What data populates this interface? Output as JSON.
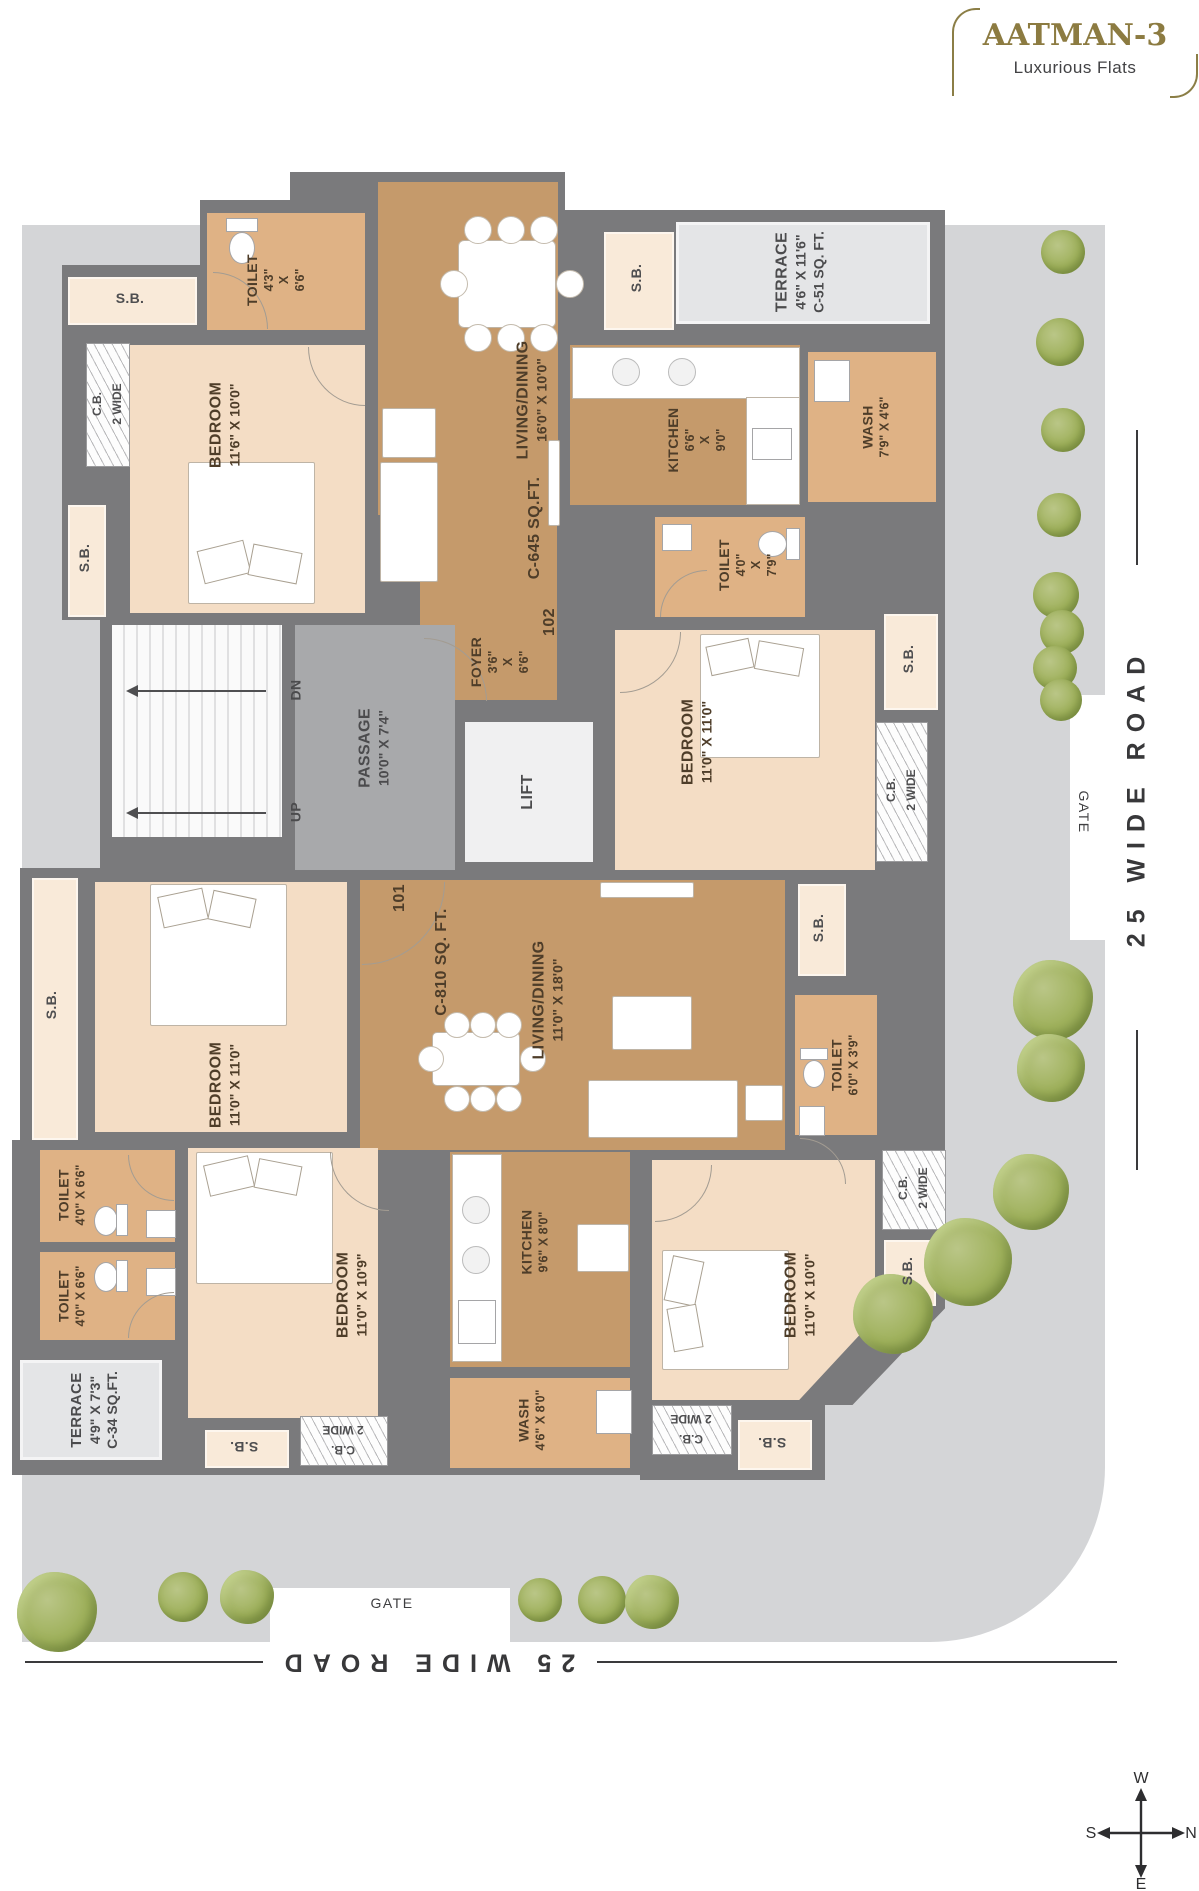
{
  "project": {
    "name": "AATMAN-3",
    "tagline": "Luxurious Flats"
  },
  "units": {
    "u102": {
      "number": "102",
      "area": "C-645 SQ.FT.",
      "toilet_a": {
        "name": "TOILET",
        "dim": "4'3\"\nX\n6'6\""
      },
      "living": {
        "name": "LIVING/DINING",
        "dim": "16'0\" X 10'0\""
      },
      "bedroom_a": {
        "name": "BEDROOM",
        "dim": "11'6\" X 10'0\""
      },
      "kitchen": {
        "name": "KITCHEN",
        "dim": "6'6\"\nX\n9'0\""
      },
      "wash": {
        "name": "WASH",
        "dim": "7'9\" X 4'6\""
      },
      "toilet_b": {
        "name": "TOILET",
        "dim": "4'0\"\nX\n7'9\""
      },
      "bedroom_b": {
        "name": "BEDROOM",
        "dim": "11'0\" X 11'0\""
      },
      "foyer": {
        "name": "FOYER",
        "dim": "3'6\"\nX\n6'6\""
      },
      "terrace": {
        "name": "TERRACE",
        "dim": "4'6\" X 11'6\"",
        "area": "C-51 SQ. FT."
      }
    },
    "u101": {
      "number": "101",
      "area": "C-810 SQ. FT.",
      "living": {
        "name": "LIVING/DINING",
        "dim": "11'0\" X 18'0\""
      },
      "bedroom_a": {
        "name": "BEDROOM",
        "dim": "11'0\" X 11'0\""
      },
      "bedroom_b": {
        "name": "BEDROOM",
        "dim": "11'0\" X 10'9\""
      },
      "bedroom_c": {
        "name": "BEDROOM",
        "dim": "11'0\" X 10'0\""
      },
      "kitchen": {
        "name": "KITCHEN",
        "dim": "9'6\" X 8'0\""
      },
      "wash": {
        "name": "WASH",
        "dim": "4'6\" X 8'0\""
      },
      "toilet_a": {
        "name": "TOILET",
        "dim": "4'0\" X 6'6\""
      },
      "toilet_b": {
        "name": "TOILET",
        "dim": "4'0\" X 6'6\""
      },
      "toilet_c": {
        "name": "TOILET",
        "dim": "6'0\" X 3'9\""
      },
      "terrace": {
        "name": "TERRACE",
        "dim": "4'9\" X 7'3\"",
        "area": "C-34 SQ.FT."
      }
    }
  },
  "common": {
    "passage": {
      "name": "PASSAGE",
      "dim": "10'0\" X 7'4\""
    },
    "lift": "LIFT",
    "dn": "DN",
    "up": "UP",
    "sb": "S.B.",
    "cb": "C.B.\n2 WIDE"
  },
  "site": {
    "road_right": "25 WIDE ROAD",
    "road_bottom": "25 WIDE ROAD",
    "gate_right": "GATE",
    "gate_bottom": "GATE"
  },
  "compass": {
    "top": "W",
    "right": "N",
    "left": "S",
    "bottom": "E"
  },
  "colors": {
    "accent_gold": "#8c7b41",
    "wall": "#7a7a7c",
    "living_floor": "#c59a6b",
    "toilet_floor": "#dfb285",
    "bedroom_floor": "#f4ddc5",
    "pavement": "#d4d5d7"
  }
}
